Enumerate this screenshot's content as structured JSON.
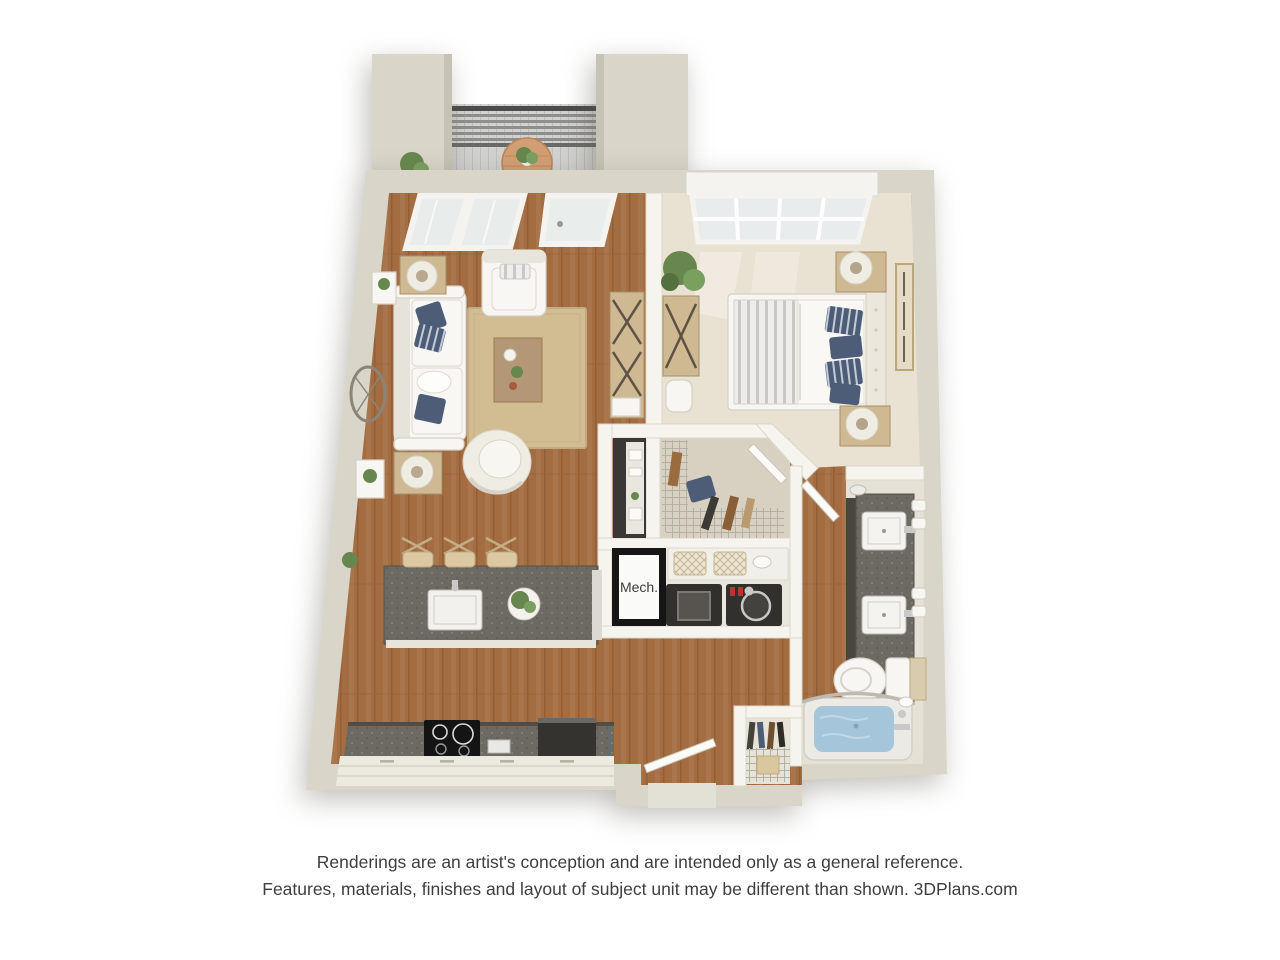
{
  "image": {
    "kind": "3d-floor-plan-rendering",
    "unit_type": "one-bedroom apartment with balcony",
    "rooms": [
      "balcony",
      "living-room",
      "bedroom",
      "walk-in-closet",
      "mechanical-closet",
      "laundry",
      "kitchen",
      "entry",
      "coat-closet",
      "bathroom"
    ],
    "labels": {
      "mech": "Mech."
    }
  },
  "caption": {
    "line1": "Renderings are an artist's conception and are intended only as a general reference.",
    "line2": "Features, materials, finishes and layout of subject unit may be different than shown. 3DPlans.com"
  },
  "palette": {
    "pageBg": "#ffffff",
    "wall": "#d9d5c8",
    "wallFace": "#c6c2b5",
    "innerWall": "#f6f4ee",
    "wood": "#a46c41",
    "carpet": "#e9e1d1",
    "tile": "#e6e1d6",
    "closetFloor": "#d8d1c2",
    "deck": "#d2d2d0",
    "rug": "#d2bd93",
    "counter": "#6d6963",
    "appliance": "#32302d",
    "white": "#f7f6f2",
    "cream": "#efece4",
    "navy": "#4d5d78",
    "water": "#a5c6da",
    "green": "#67874f",
    "woodFurn": "#cfb992",
    "woodTable": "#b39776",
    "metal": "#c9c9c9",
    "frameBlack": "#161616",
    "text": "#3e3e3e"
  }
}
